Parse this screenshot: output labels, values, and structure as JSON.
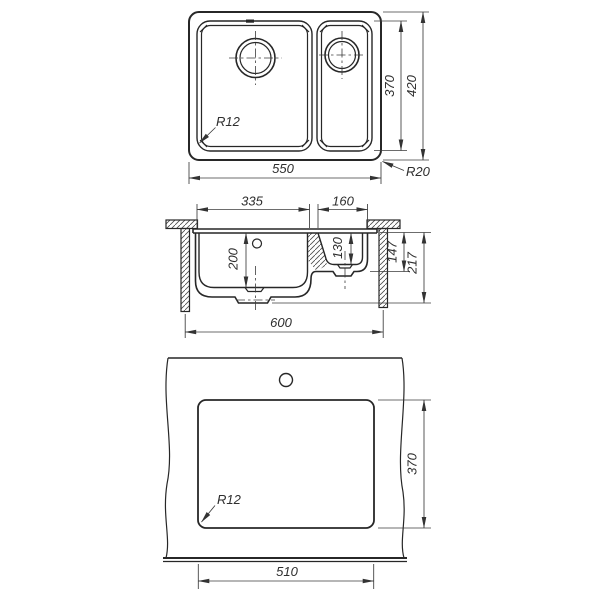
{
  "top_view": {
    "overall_width": "550",
    "bowl_area_depth": "370",
    "overall_depth": "420",
    "bowl_corner_radius": "R12",
    "rim_corner_radius": "R20"
  },
  "section_view": {
    "main_bowl_width": "335",
    "small_bowl_width": "160",
    "main_bowl_depth": "200",
    "small_bowl_depth": "130",
    "small_bowl_height": "147",
    "overall_height": "217",
    "base_cabinet_width": "600"
  },
  "cutout_view": {
    "cutout_width": "510",
    "cutout_depth": "370",
    "corner_radius": "R12"
  }
}
